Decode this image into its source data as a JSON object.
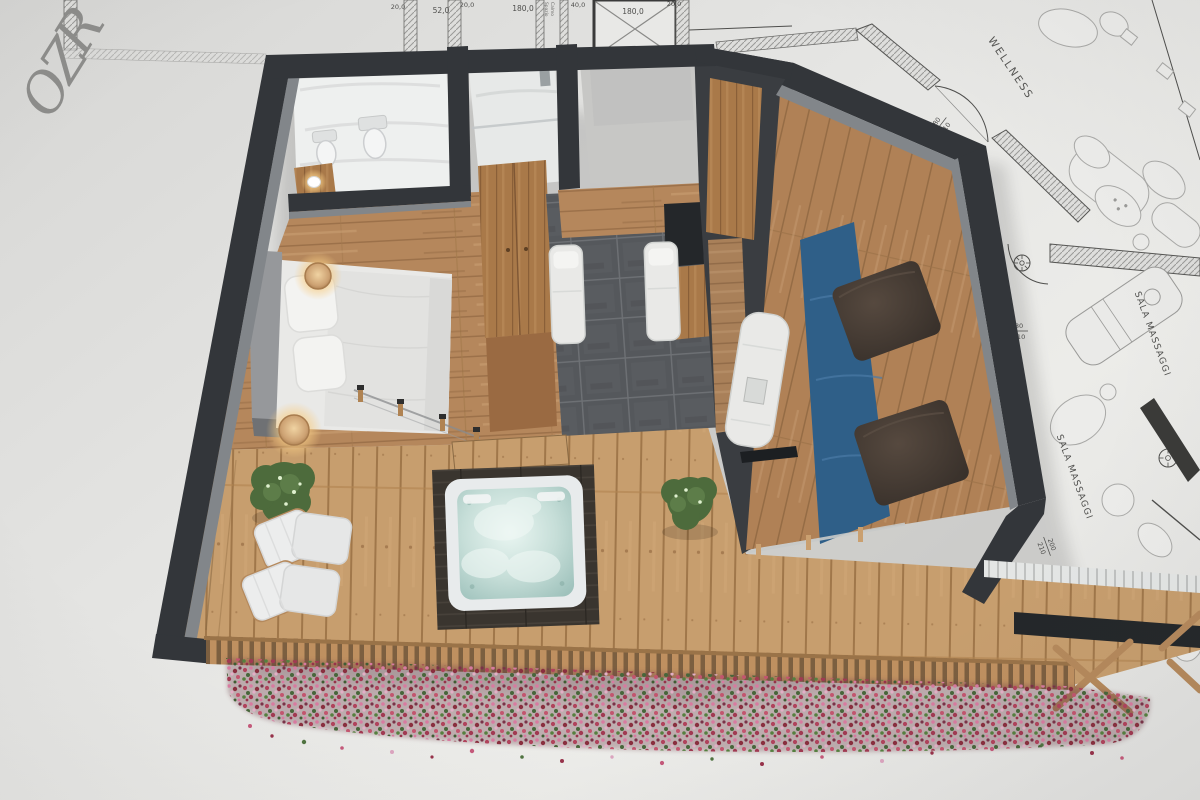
{
  "scene": {
    "description": "3D rendered hotel wellness-suite floor plan over architectural blueprint",
    "floor_label": {
      "text": "RZO",
      "chars": [
        "R",
        "Z",
        "O"
      ]
    }
  },
  "blueprint": {
    "top_dimensions": [
      "20,0",
      "52,0",
      "20,0",
      "180,0",
      "40,0",
      "180,0",
      "20,0"
    ],
    "stairwell_label": {
      "line1": "Spazio",
      "line2": "Calmo"
    },
    "rooms": {
      "wellness": "WELLNESS",
      "massage": "SALA MASSAGGI"
    },
    "door_dimensions": [
      {
        "w": "80",
        "h": "210"
      },
      {
        "w": "80",
        "h": "210"
      },
      {
        "w": "200",
        "h": "210"
      }
    ]
  },
  "colors": {
    "paper": "#e2e2e0",
    "blueprint_line": "#4e4e4c",
    "wall": "#33363a",
    "wall_face": "#82868a",
    "deck_wood": "#c79e6e",
    "floor_wood": "#b5875c",
    "tile": "#55585c",
    "pool": "#2f5f88",
    "jacuzzi_water": "#cfe6e0",
    "bedding": "#e9e9e7",
    "pouf": "#463d37",
    "plant": "#4d6b3c",
    "flower_pink": "#c4597a",
    "lamp_glow": "#ffd98f"
  }
}
